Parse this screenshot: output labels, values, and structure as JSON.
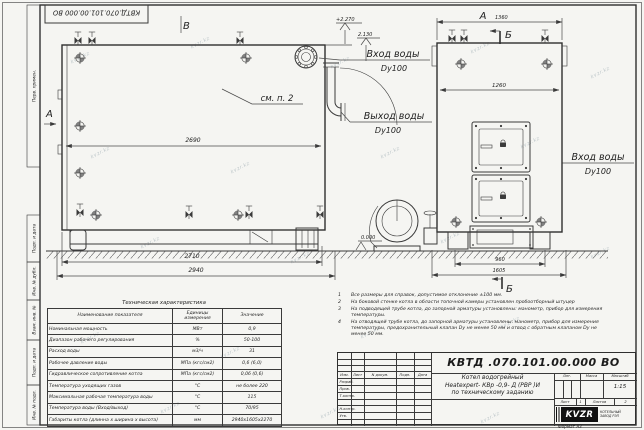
{
  "watermark": {
    "text": "kvzr.kz"
  },
  "frame": {
    "doc_number_top": "КВТД.070.101.00.000 ВО",
    "margin_labels": {
      "perv": "Перв. примен.",
      "podp1": "Подп. и дата",
      "inv_dubl": "Инв. № дубл.",
      "vzam": "Взам. инв. №",
      "podp2": "Подп. и дата",
      "inv_podl": "Инв. № подл."
    }
  },
  "drawing": {
    "views": {
      "side_a": "А",
      "side_b": "В",
      "front_a": "А",
      "sec_top": "Б",
      "sec_bottom": "Б",
      "see_note": "см. п. 2"
    },
    "dims": {
      "d2690": "2690",
      "d2710": "2710",
      "d2940": "2940",
      "d1360": "1360",
      "d1260": "1260",
      "d960": "960",
      "d1605": "1605"
    },
    "elev": {
      "top": "+2.270",
      "pipe": "2.130",
      "zero": "0.000"
    },
    "labels": {
      "inlet_side": "Вход воды",
      "inlet_side_dn": "Dy100",
      "outlet": "Выход воды",
      "outlet_dn": "Dy100",
      "inlet_front": "Вход воды",
      "inlet_front_dn": "Dy100"
    }
  },
  "notes": {
    "items": [
      {
        "num": "1",
        "text": "Все размеры для справок, допустимое отклонение ±100 мм."
      },
      {
        "num": "2",
        "text": "На боковой стенке котла в области топочной камеры установлен пробоотборный штуцер"
      },
      {
        "num": "3",
        "text": "На подводящей трубе котла, до запорной арматуры установлены: манометр, прибор для измерения температуры."
      },
      {
        "num": "4",
        "text": "На отводящей трубе котла, до запорной арматуры установлены: манометр, прибор для измерения температуры, предохранительный клапан Dу не менее 50 мм и отвод с обратным клапаном Dу не менее 50 мм."
      }
    ]
  },
  "tech_table": {
    "title": "Техническая характеристика",
    "headers": {
      "name": "Наименование показателя",
      "unit": "Единицы измерения",
      "value": "Значение"
    },
    "rows": [
      {
        "name": "Номинальная мощность",
        "unit": "МВт",
        "value": "0,9"
      },
      {
        "name": "Диапазон рабочего регулирования",
        "unit": "%",
        "value": "50-100"
      },
      {
        "name": "Расход воды",
        "unit": "м3/ч",
        "value": "31"
      },
      {
        "name": "Рабочее давление воды",
        "unit": "МПа (кгс/см2)",
        "value": "0,6 (6,0)"
      },
      {
        "name": "Гидравлическое сопротивление котла",
        "unit": "МПа (кгс/см2)",
        "value": "0,06 (0,6)"
      },
      {
        "name": "Температура уходящих газов",
        "unit": "°С",
        "value": "не более 220"
      },
      {
        "name": "Максимальная рабочая температура воды",
        "unit": "°С",
        "value": "115"
      },
      {
        "name": "Температура воды (Вход/выход)",
        "unit": "°С",
        "value": "70/95"
      },
      {
        "name": "Габариты котла (длинна х ширина х высота)",
        "unit": "мм",
        "value": "2940х1605х2270"
      }
    ]
  },
  "title_block": {
    "doc_number": "КВТД .070.101.00.000  ВО",
    "product": {
      "line1": "Котел водогрейный",
      "line2": "Heatexpert- КВр -0,9- Д (РВР )И",
      "line3": "по техническому заданию"
    },
    "sig_header": {
      "izm": "Изм.",
      "list": "Лист",
      "ndoc": "N докум.",
      "podp": "Подп.",
      "data": "Дата"
    },
    "sig_rows": {
      "razrab": "Разраб.",
      "prov": "Пров.",
      "tkontr": "Т.контр.",
      "nkontr": "Н.контр.",
      "utv": "Утв."
    },
    "props": {
      "lit": "Лит.",
      "massa": "Масса",
      "scale_label": "Масштаб",
      "scale": "1:15",
      "sheet_label": "Лист",
      "sheet_num": "1",
      "sheets_label": "Листов",
      "sheets_num": "2"
    },
    "logo": {
      "brand": "KVZR",
      "company_line1": "КОТЕЛЬНЫЙ",
      "company_line2": "ЗАВОД РЭП"
    },
    "format": "Формат  А3"
  }
}
